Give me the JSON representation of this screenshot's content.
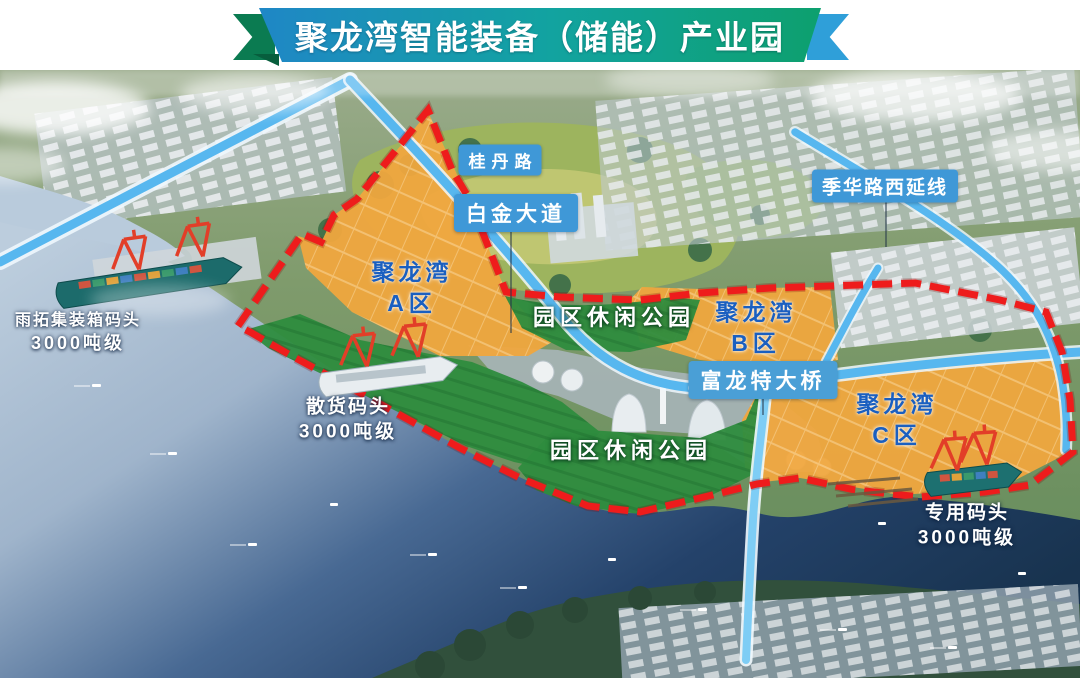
{
  "banner": {
    "title": "聚龙湾智能装备（储能）产业园"
  },
  "map": {
    "zones": [
      {
        "name": "聚龙湾",
        "district": "A区"
      },
      {
        "name": "聚龙湾",
        "district": "B区"
      },
      {
        "name": "聚龙湾",
        "district": "C区"
      }
    ],
    "parks": [
      {
        "label": "园区休闲公园"
      },
      {
        "label": "园区休闲公园"
      }
    ],
    "roads": [
      {
        "label": "桂丹路"
      },
      {
        "label": "白金大道"
      },
      {
        "label": "季华路西延线"
      },
      {
        "label": "富龙特大桥"
      }
    ],
    "docks": [
      {
        "name": "雨拓集装箱码头",
        "capacity": "3000吨级"
      },
      {
        "name": "散货码头",
        "capacity": "3000吨级"
      },
      {
        "name": "专用码头",
        "capacity": "3000吨级"
      }
    ]
  },
  "colors": {
    "banner_blue": "#1f87c6",
    "banner_green": "#0da06e",
    "zone_fill_orange": "#f0a73e",
    "park_fill_green": "#2e8c3e",
    "boundary_red": "#ee1c1c",
    "road_blue": "#57b7ef",
    "label_bg_blue": "#3f98d7",
    "zone_text_blue": "#1a5fc0"
  }
}
